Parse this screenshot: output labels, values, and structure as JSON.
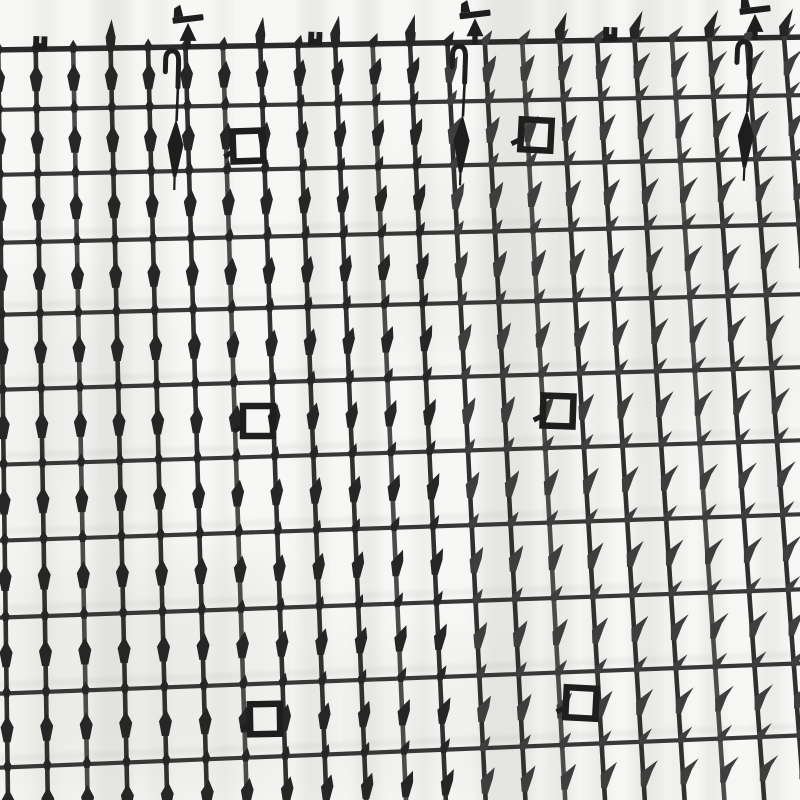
{
  "meta": {
    "alt": "Black plastic anti-cat spike deterrent mat grid with prickle strips, hooks, pegs and square connector loops, photographed at an angle on a white background"
  },
  "palette": {
    "bg": "#f7f7f5",
    "streak": "#d7d7d3",
    "patch": "#e3e3df",
    "echo": "#8c8c8c",
    "wireDark": "#303030",
    "wireLight": "#4b4b4b",
    "wireHorizontal": "#383838",
    "edge": "#2b2b2b",
    "spikeDark": "#262626",
    "spikeMid": "#3e3e3e",
    "feature": "#1e1e1e"
  },
  "canvas": {
    "width": 800,
    "height": 800
  },
  "grid": {
    "yTopRef": 30,
    "yBotRef": 800,
    "cols": {
      "count": 23,
      "xTopStart": -2,
      "xTopStep": 37.4,
      "xBotStart": 8,
      "xBotStep": 39.8,
      "lightEvery": [
        2,
        6,
        10,
        14,
        18,
        22
      ]
    },
    "rows": {
      "yLeft": [
        50,
        110,
        175,
        243,
        315,
        390,
        465,
        541,
        618,
        694,
        768
      ],
      "tiltBase": 13,
      "tiltStep": 2.0,
      "virtualNextY": 840,
      "virtualTilt": 35
    },
    "stroke": {
      "vertical": 4.6,
      "horizontal": 4.2,
      "edge": 5.5
    }
  },
  "spikes": {
    "leanStartX": 140,
    "leanEndX": 700,
    "diamond": [
      [
        0,
        -15
      ],
      [
        6.5,
        -3
      ],
      [
        3.5,
        12
      ],
      [
        -3.5,
        12
      ],
      [
        -6.5,
        -3
      ]
    ],
    "thorn": [
      [
        16,
        -17
      ],
      [
        9,
        -6
      ],
      [
        3,
        9
      ],
      [
        -2.5,
        9
      ],
      [
        -2.5,
        -4
      ]
    ],
    "knotDiamond": [
      [
        0,
        -8
      ],
      [
        4,
        -1
      ],
      [
        2.5,
        5
      ],
      [
        -2.5,
        5
      ],
      [
        -4,
        -1
      ]
    ],
    "knotThorn": [
      [
        12,
        -13
      ],
      [
        6.5,
        -4
      ],
      [
        2.5,
        4
      ],
      [
        -2.5,
        4
      ],
      [
        -2.5,
        -3
      ]
    ],
    "upSpike": [
      [
        1,
        -28
      ],
      [
        5,
        -10
      ],
      [
        4,
        0
      ],
      [
        -4,
        0
      ],
      [
        -5,
        -10
      ]
    ],
    "upSpikeLean": 8
  },
  "features": {
    "topSpikeCols": [
      3,
      7,
      9,
      11,
      15,
      17,
      19,
      21
    ],
    "tabs": [
      {
        "x": 40
      },
      {
        "x": 315
      },
      {
        "x": 610
      }
    ],
    "tpegs": [
      {
        "x": 188
      },
      {
        "x": 475
      },
      {
        "x": 755
      }
    ],
    "pins": [
      {
        "x": 178,
        "rot": 1.5
      },
      {
        "x": 465,
        "rot": 2
      },
      {
        "x": 750,
        "rot": 2.5
      }
    ],
    "squares": [
      {
        "cx": 248,
        "cy": 146,
        "rot": -2
      },
      {
        "cx": 536,
        "cy": 135,
        "rot": 3
      },
      {
        "cx": 258,
        "cy": 421,
        "rot": 0
      },
      {
        "cx": 558,
        "cy": 411,
        "rot": 2
      },
      {
        "cx": 265,
        "cy": 719,
        "rot": -1
      },
      {
        "cx": 581,
        "cy": 703,
        "rot": 3
      }
    ],
    "streaks": [
      {
        "x": 35,
        "w": 20,
        "o": 0.3
      },
      {
        "x": 95,
        "w": 34,
        "o": 0.45
      },
      {
        "x": 150,
        "w": 18,
        "o": 0.28
      },
      {
        "x": 215,
        "w": 16,
        "o": 0.25
      },
      {
        "x": 300,
        "w": 26,
        "o": 0.4
      },
      {
        "x": 358,
        "w": 20,
        "o": 0.45
      },
      {
        "x": 415,
        "w": 16,
        "o": 0.3
      },
      {
        "x": 480,
        "w": 55,
        "o": 0.5
      },
      {
        "x": 545,
        "w": 28,
        "o": 0.45
      },
      {
        "x": 588,
        "w": 20,
        "o": 0.35
      },
      {
        "x": 632,
        "w": 30,
        "o": 0.45
      },
      {
        "x": 670,
        "w": 14,
        "o": 0.3
      },
      {
        "x": 703,
        "w": 20,
        "o": 0.4
      },
      {
        "x": 758,
        "w": 24,
        "o": 0.35
      }
    ],
    "patches": [
      {
        "x": 0,
        "y": 560,
        "w": 280,
        "h": 240,
        "o": 0.5
      },
      {
        "x": 0,
        "y": 280,
        "w": 160,
        "h": 260,
        "o": 0.35
      },
      {
        "x": 300,
        "y": 640,
        "w": 220,
        "h": 160,
        "o": 0.3
      },
      {
        "x": 620,
        "y": 180,
        "w": 180,
        "h": 240,
        "o": 0.25
      },
      {
        "x": 360,
        "y": 170,
        "w": 200,
        "h": 180,
        "o": 0.28
      }
    ],
    "echoRows": [
      3,
      4,
      5,
      6,
      7,
      8,
      9,
      10
    ],
    "echoOffset": -9
  }
}
